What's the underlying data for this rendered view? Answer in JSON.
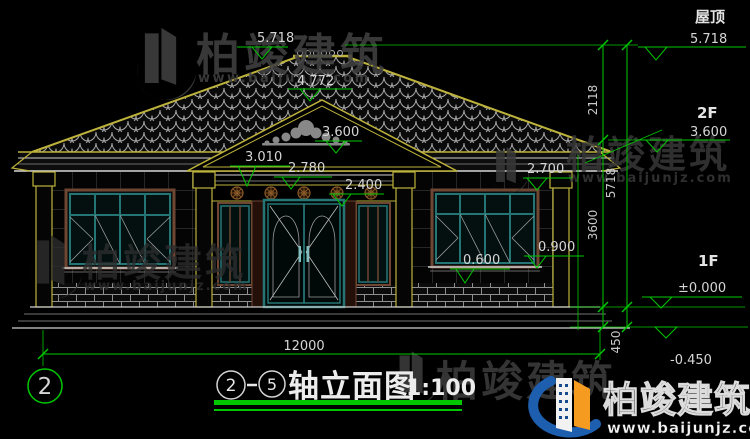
{
  "drawing": {
    "labels": {
      "roof": "屋顶",
      "floor2": "2F",
      "floor1": "1F"
    },
    "levels": {
      "roof_top": "5.718",
      "roof_mid": "4.772",
      "gable": "3.600",
      "floor2": "3.600",
      "eave_left": "3.010",
      "porch_beam": "2.780",
      "door_head": "2.400",
      "eave_right": "2.700",
      "sill_left": "0.600",
      "sill_right": "0.900",
      "ground": "±0.000",
      "plinth": "-0.450"
    },
    "dims": {
      "total_width": "12000",
      "roof_height": "2118",
      "floor_height": "3600",
      "total_height": "5718",
      "plinth_height": "450"
    },
    "grid_axis": "2",
    "title": {
      "axis_from": "2",
      "axis_to": "5",
      "name": "轴立面图",
      "scale": "1:100"
    }
  },
  "watermark": {
    "brand": "柏竣建筑",
    "url": "www.baijunjz.com"
  },
  "colors": {
    "dim_green": "#00c800",
    "roof_yellow": "#bdb23b",
    "window_teal": "#257575",
    "frame_brown": "#6e4632",
    "logo_blue": "#1d5fae",
    "logo_orange": "#f59b20"
  }
}
